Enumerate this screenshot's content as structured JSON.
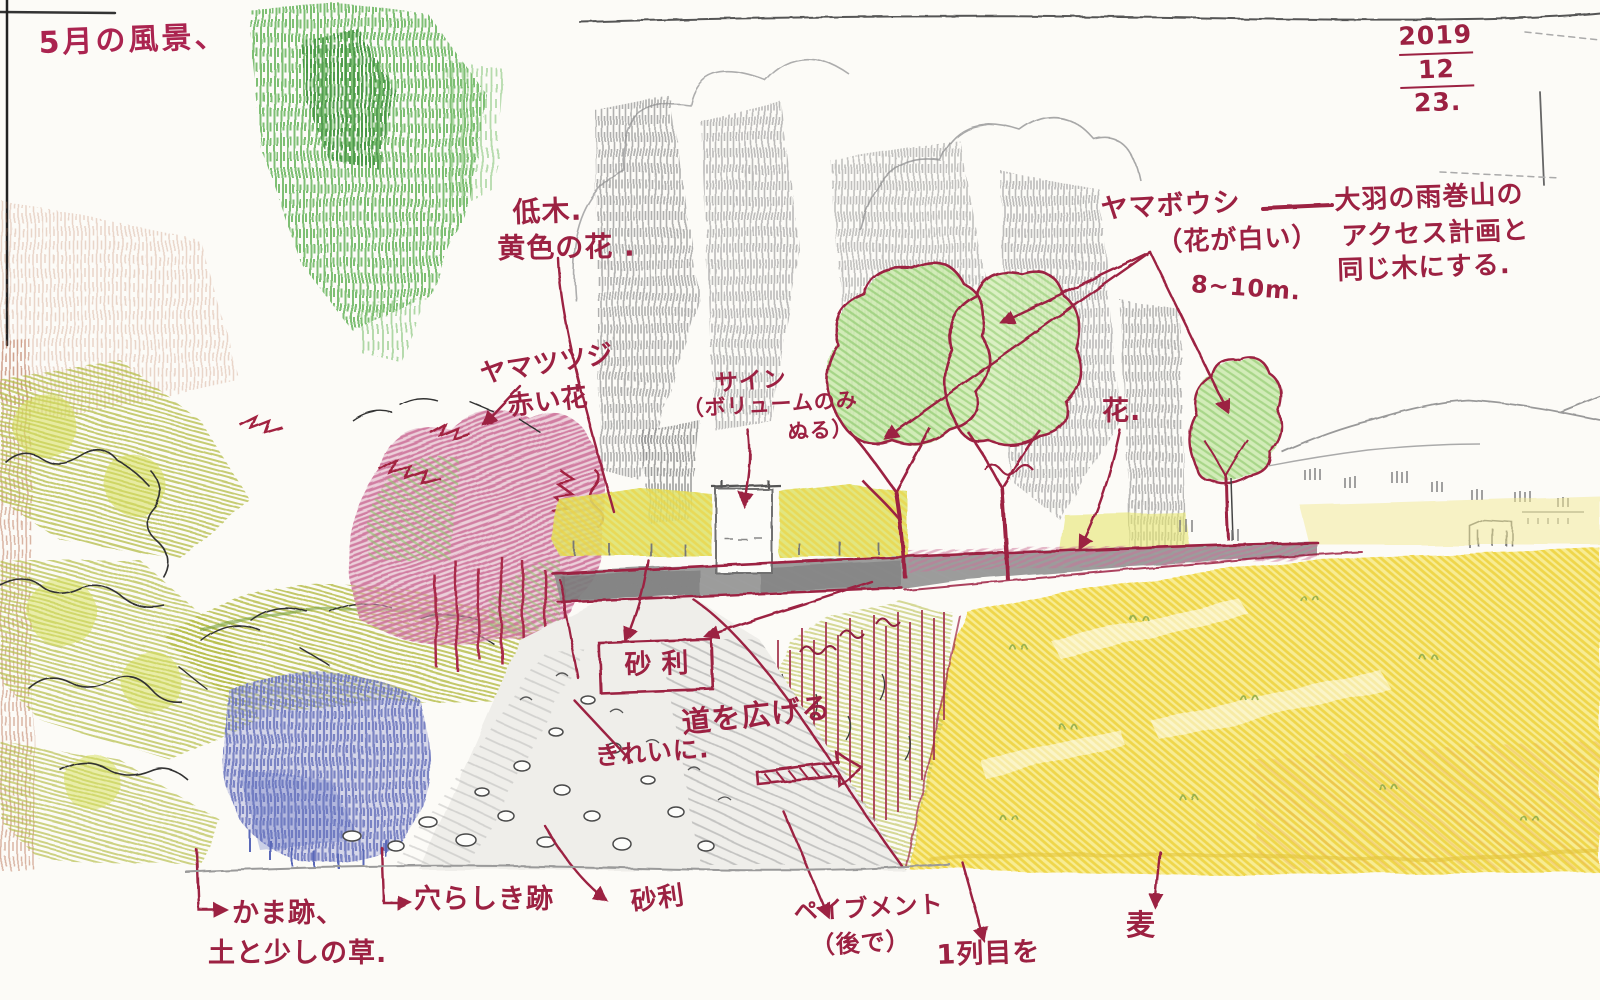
{
  "document": {
    "title": "5月の風景、",
    "date": {
      "year": "2019",
      "month": "12",
      "day": "23."
    }
  },
  "annotations": {
    "lowtree_line1": "低木.",
    "lowtree_line2": "黄色の花 .",
    "tsutsuji_line1": "ヤマツツジ",
    "tsutsuji_line2": "赤い花",
    "sign_line1": "サイン",
    "sign_line2": "（ボリュームのみ",
    "sign_line3": "ぬる）",
    "yamaboushi_name": "ヤマボウシ",
    "yamaboushi_white": "（花が白い）",
    "yamaboushi_height": "8~10m.",
    "access_line1": "大羽の雨巻山の",
    "access_line2": "アクセス計画と",
    "access_line3": "同じ木にする.",
    "flower": "花.",
    "gravel_boxed": "砂利",
    "neatly": "きれいに.",
    "widen_road": "道を広げる",
    "kama_line1": "かま跡、",
    "kama_line2": "土と少しの草.",
    "hole_trace": "穴らしき跡",
    "gravel_path": "砂利",
    "pavement_line1": "ペイブメント",
    "pavement_line2": "（後で）",
    "first_row": "1列目を",
    "wheat": "麦"
  },
  "colors": {
    "pen_red": "#9c2142",
    "foliage_green": "#8cc86a",
    "field_yellow": "#eed23e",
    "flower_purple": "#6b74bd",
    "flower_pink": "#cc6f97",
    "road_gray": "#8b8b8b"
  }
}
